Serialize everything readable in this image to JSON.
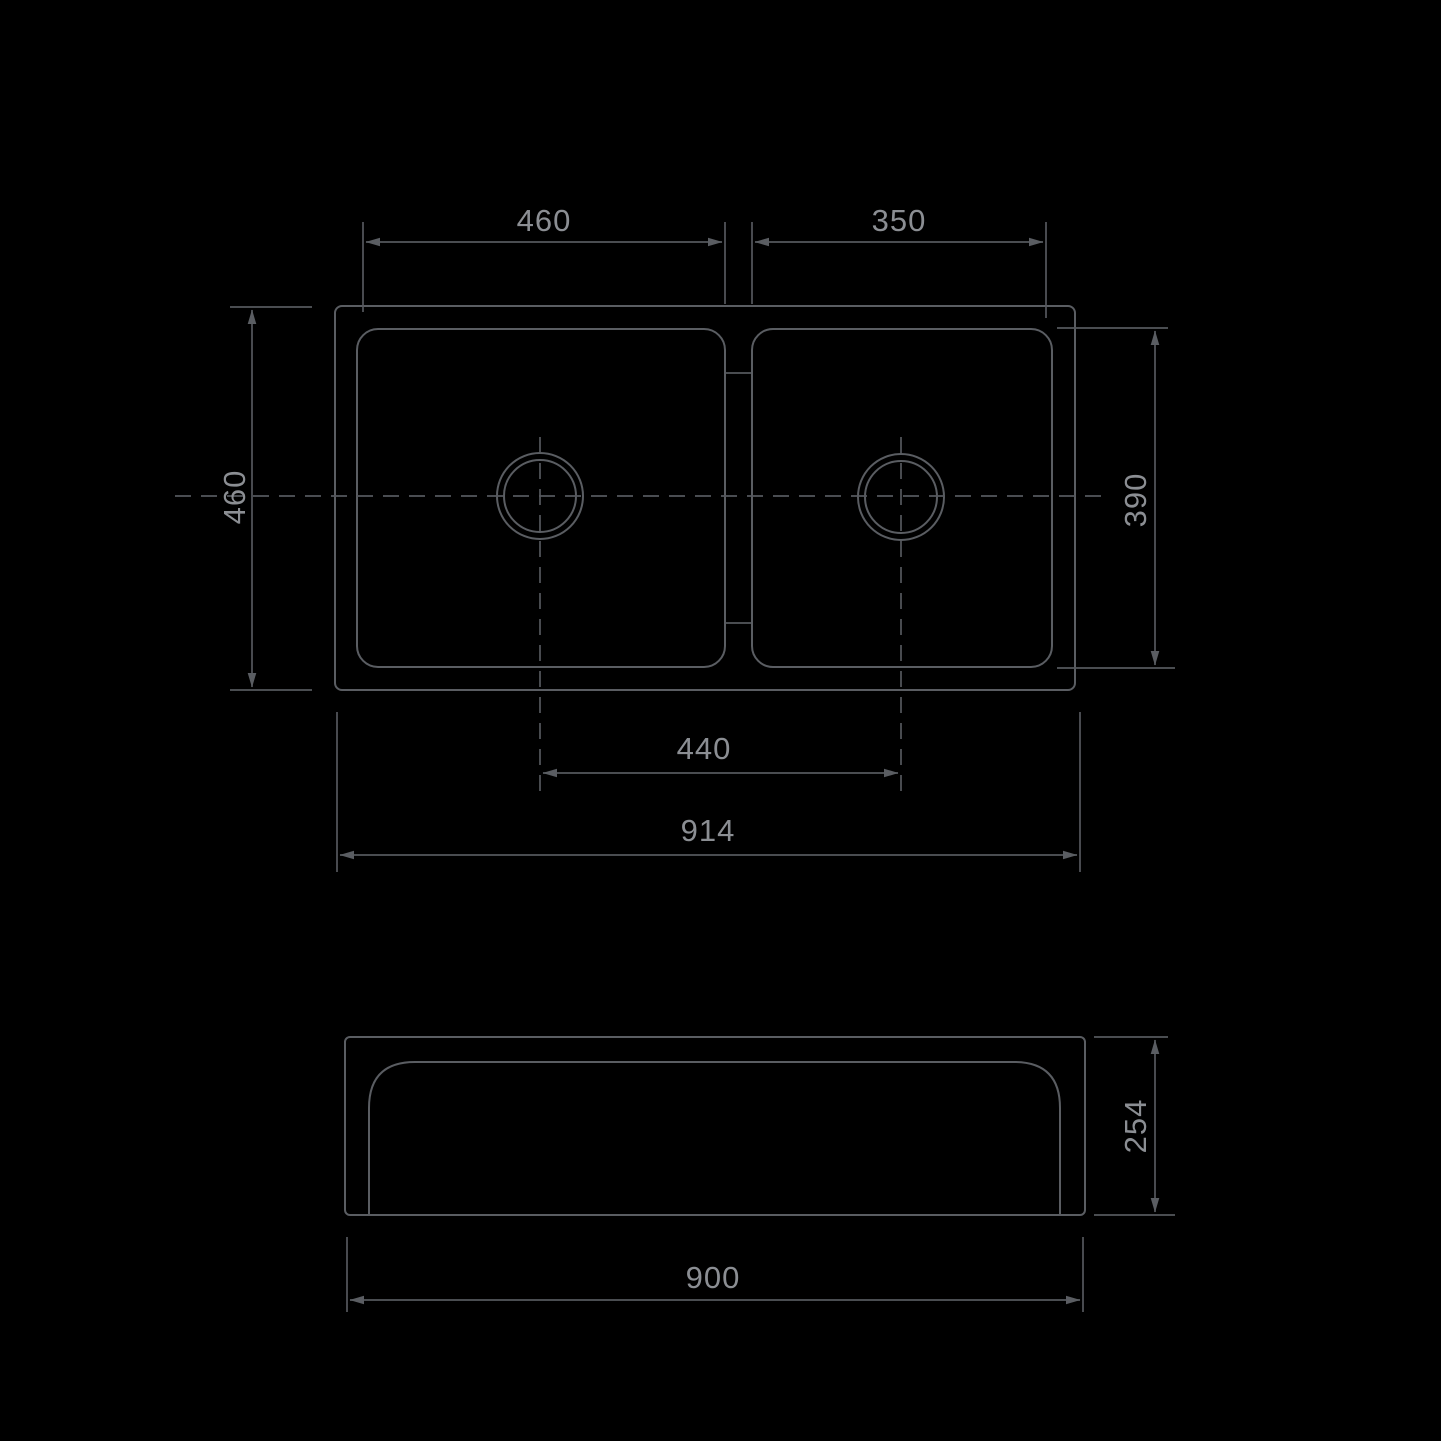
{
  "page": {
    "background_color": "#000000",
    "line_color": "#5a5d62",
    "text_color": "#8b8e93",
    "content": "technical-drawing-double-bowl-sink"
  },
  "dimensions": {
    "left_bowl_width": {
      "value": "460"
    },
    "right_bowl_width": {
      "value": "350"
    },
    "overall_depth": {
      "value": "460"
    },
    "right_bowl_depth": {
      "value": "390"
    },
    "drain_spacing": {
      "value": "440"
    },
    "overall_width": {
      "value": "914"
    },
    "apron_height": {
      "value": "254"
    },
    "base_width": {
      "value": "900"
    }
  }
}
